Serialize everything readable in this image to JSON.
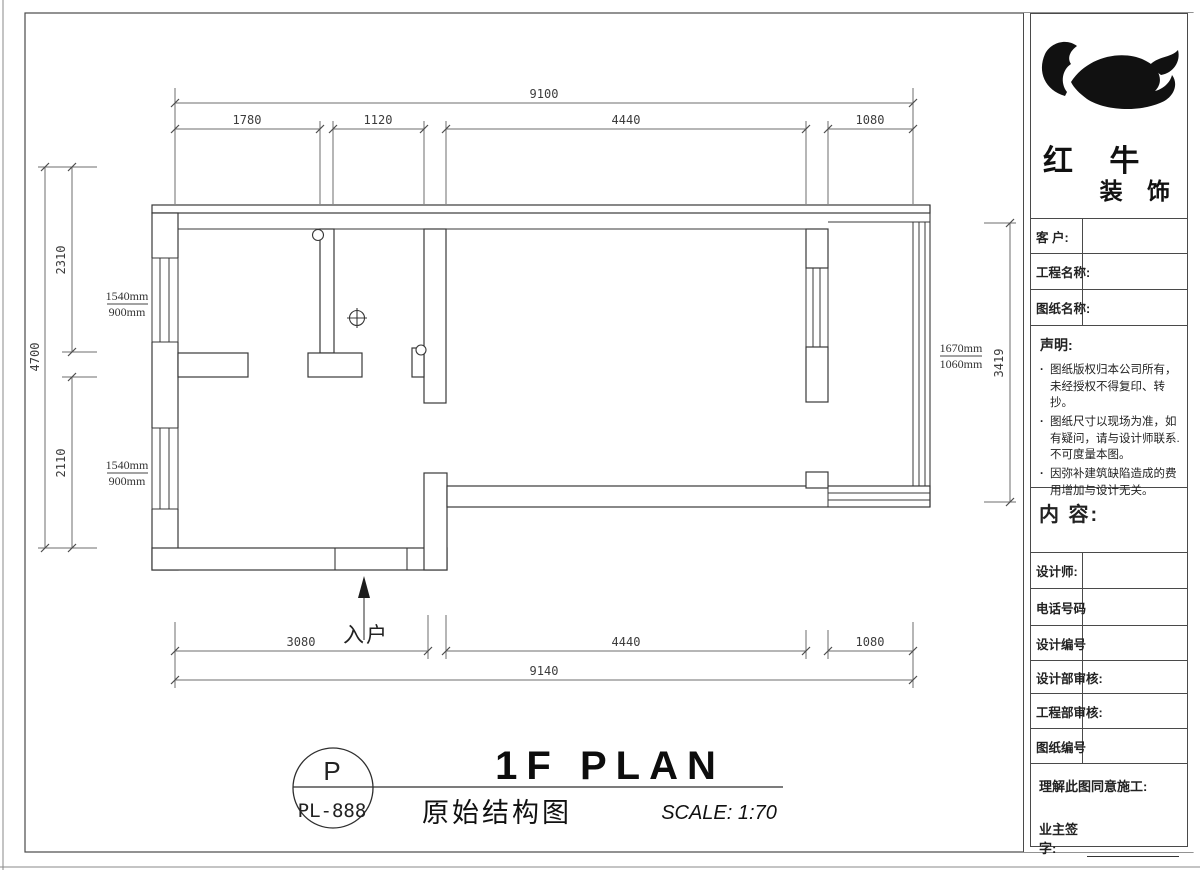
{
  "sheet": {
    "plan": {
      "entrance_label": "入户"
    },
    "dimensions": {
      "top": {
        "overall": "9100",
        "segments": [
          "1780",
          "1120",
          "4440",
          "1080"
        ]
      },
      "bottom": {
        "overall": "9140",
        "segments": [
          "3080",
          "4440",
          "1080"
        ]
      },
      "left": {
        "overall": "4700",
        "segments": [
          "2310",
          "2110"
        ]
      },
      "right": {
        "overall": "3419"
      },
      "window_tags": [
        {
          "w": "1540mm",
          "h": "900mm"
        },
        {
          "w": "1540mm",
          "h": "900mm"
        },
        {
          "w": "1670mm",
          "h": "1060mm"
        }
      ]
    },
    "titlebar": {
      "bubble_top": "P",
      "bubble_bottom": "PL-888",
      "title_en": "1F PLAN",
      "title_cn": "原始结构图",
      "scale": "SCALE: 1:70"
    }
  },
  "titleblock": {
    "brand": {
      "line1": "红 牛",
      "line2": "装 饰"
    },
    "bullet_char": "·",
    "fields": {
      "client": "客  户:",
      "project_name": "工程名称:",
      "drawing_name": "图纸名称:",
      "designer": "设计师:",
      "phone": "电话号码",
      "design_no": "设计编号",
      "design_dept_review": "设计部审核:",
      "engineering_dept_review": "工程部审核:",
      "drawing_no": "图纸编号"
    },
    "notice": {
      "title": "声明:",
      "items": [
        "图纸版权归本公司所有，未经授权不得复印、转抄。",
        "图纸尺寸以现场为准，如有疑问，请与设计师联系. 不可度量本图。",
        "因弥补建筑缺陷造成的费用增加与设计无关。"
      ]
    },
    "content_label": "内 容:",
    "approval": {
      "line1": "理解此图同意施工:",
      "line2": "业主签字:"
    }
  }
}
